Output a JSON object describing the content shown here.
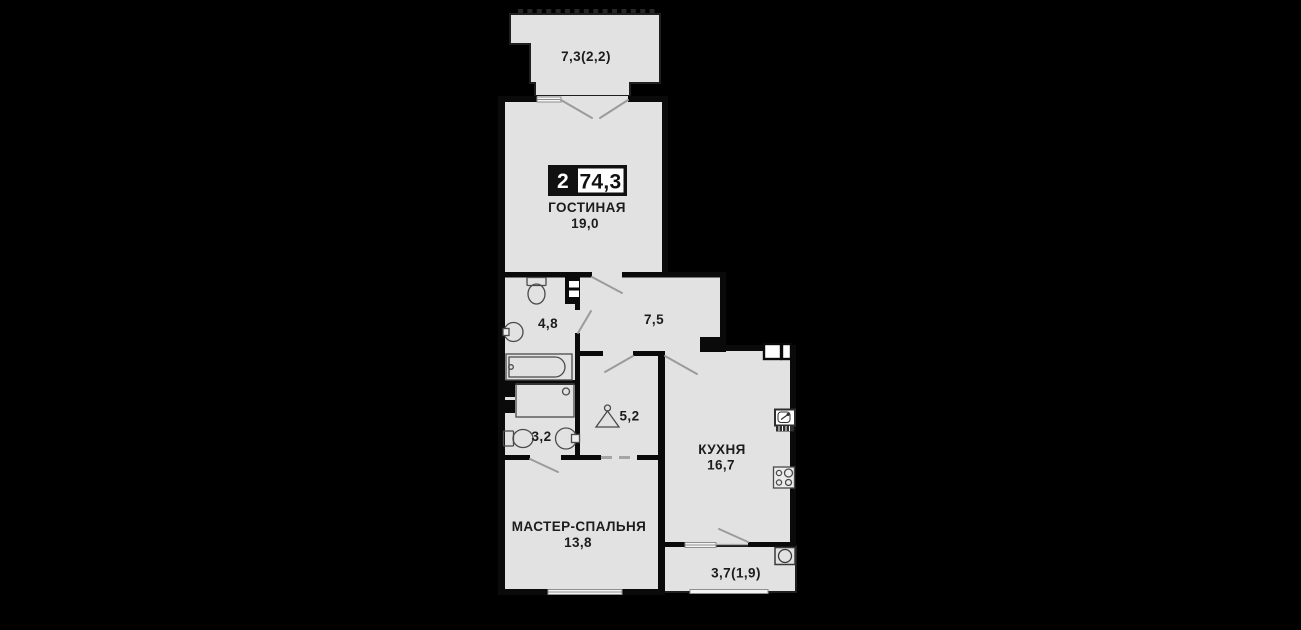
{
  "plan": {
    "badge": {
      "rooms_count": "2",
      "total_area": "74,3"
    },
    "rooms": {
      "balcony_top": {
        "area": "7,3(2,2)"
      },
      "living": {
        "name": "ГОСТИНАЯ",
        "area": "19,0"
      },
      "bathroom": {
        "area": "4,8"
      },
      "hall": {
        "area": "7,5"
      },
      "wardrobe": {
        "area": "5,2"
      },
      "wc": {
        "area": "3,2"
      },
      "kitchen": {
        "name": "КУХНЯ",
        "area": "16,7"
      },
      "master_bedroom": {
        "name": "МАСТЕР-СПАЛЬНЯ",
        "area": "13,8"
      },
      "balcony_bottom": {
        "area": "3,7(1,9)"
      }
    },
    "colors": {
      "background": "#000000",
      "floor": "#e2e2e2",
      "wall": "#0a0a0a",
      "opening_lines": "#9b9b9b",
      "badge_box": "#111111",
      "badge_area_bg": "#ffffff",
      "text": "#1c1c1c"
    }
  }
}
